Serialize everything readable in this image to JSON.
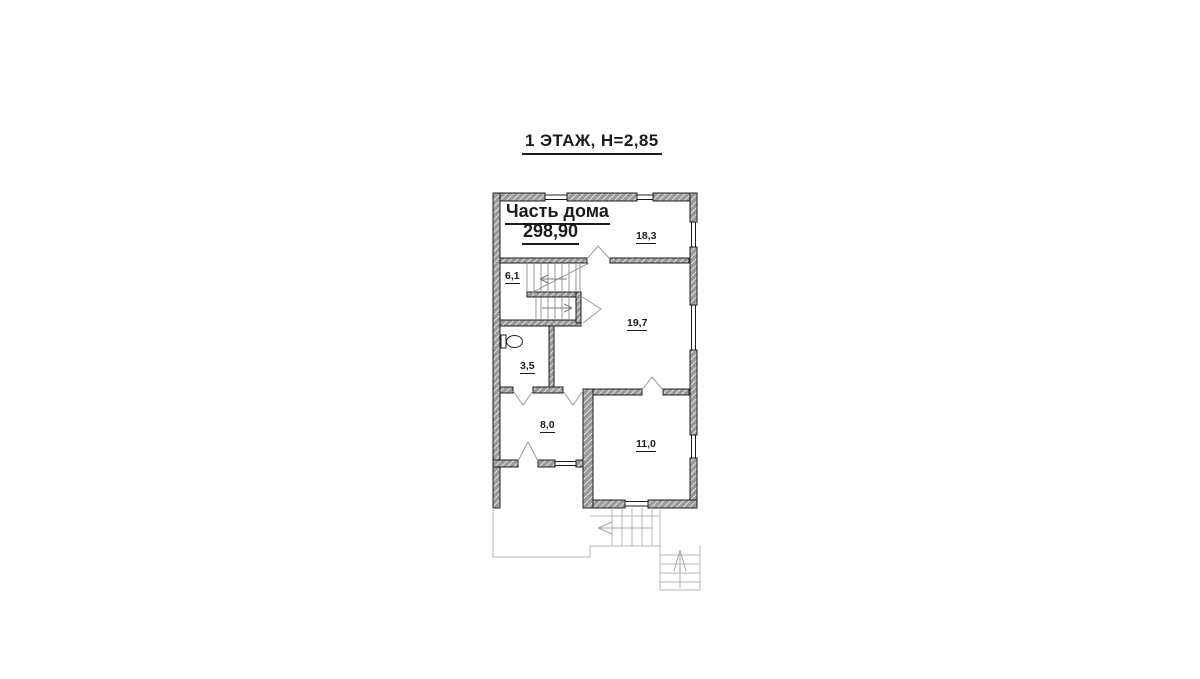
{
  "title": {
    "text": "1 ЭТАЖ, Н=2,85"
  },
  "stamp": {
    "line1": "Часть дома",
    "line2": "298,90"
  },
  "rooms": {
    "r183": {
      "area": "18,3"
    },
    "r61": {
      "area": "6,1"
    },
    "r197": {
      "area": "19,7"
    },
    "r35": {
      "area": "3,5"
    },
    "r80": {
      "area": "8,0"
    },
    "r110": {
      "area": "11,0"
    }
  },
  "colors": {
    "background": "#ffffff",
    "wall_hatch": "#9a9a9a",
    "wall_outline": "#1c1c1c",
    "text": "#1b1b1b",
    "door_swing": "#9a9a9a",
    "stair_line": "#8c8c8c",
    "exterior_line": "#b5b5b5"
  }
}
